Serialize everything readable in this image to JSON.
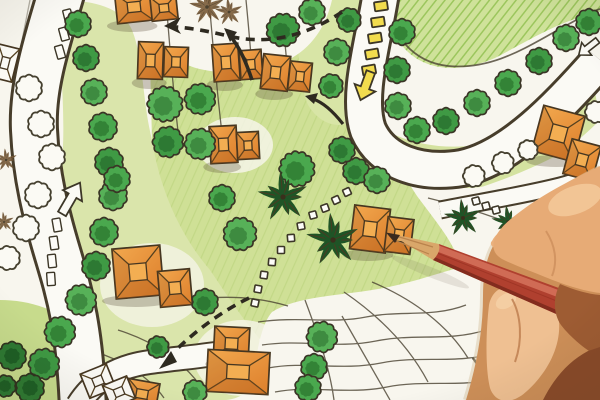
{
  "scene": {
    "title": "Landscape design site plan — colored pencil drawing",
    "description": "Photograph of a hand-drawn landscape architecture blueprint for a residential site: orange hip-roof villas, round green trees, palm symbols, curving white roads with yellow and white directional arrows, dashed pedestrian flow arrows, dotted stepping-stone walkways, and a designer's hand holding a red colored pencil pointing at a villa at center-right."
  },
  "palette": {
    "paper": "#f8f6ee",
    "lawn": "#cfe29a",
    "lawn_hatch": "#8fbf4e",
    "wash": "#dae5ab",
    "wash2": "#cfe096",
    "ink": "#3c3627",
    "tree_green": "#47a84b",
    "tree_green_dark": "#2e7d33",
    "palm_green": "#1f5426",
    "building_orange": "#eb9a40",
    "building_orange_dark": "#b25f1e",
    "road_white": "#fbfaf5",
    "marker_yellow": "#f2dc4e",
    "pencil_red": "#b0402f",
    "pencil_wood": "#d9a76a",
    "pencil_tip": "#3a2a1e",
    "skin_light": "#f3c99b",
    "skin_mid": "#e7ab76",
    "skin_base": "#cd8f58",
    "skin_shadow": "#9e5c33",
    "skin_deep": "#8a4b2a"
  },
  "plan": {
    "green_trees": [
      [
        78,
        24,
        12
      ],
      [
        86,
        58,
        12
      ],
      [
        94,
        92,
        12
      ],
      [
        103,
        127,
        13
      ],
      [
        109,
        162,
        13
      ],
      [
        113,
        196,
        13
      ],
      [
        104,
        232,
        13
      ],
      [
        96,
        266,
        13
      ],
      [
        81,
        300,
        14
      ],
      [
        60,
        332,
        14
      ],
      [
        44,
        364,
        14
      ],
      [
        165,
        104,
        16
      ],
      [
        200,
        99,
        14
      ],
      [
        168,
        142,
        14
      ],
      [
        200,
        144,
        14
      ],
      [
        117,
        179,
        12
      ],
      [
        283,
        30,
        15
      ],
      [
        312,
        12,
        12
      ],
      [
        297,
        169,
        16
      ],
      [
        356,
        171,
        12
      ],
      [
        240,
        234,
        15
      ],
      [
        222,
        198,
        12
      ],
      [
        205,
        302,
        12
      ],
      [
        322,
        337,
        14
      ],
      [
        314,
        367,
        12
      ],
      [
        158,
        347,
        10
      ],
      [
        195,
        392,
        11
      ],
      [
        308,
        388,
        12
      ],
      [
        349,
        20,
        11
      ],
      [
        337,
        52,
        12
      ],
      [
        331,
        86,
        11
      ],
      [
        342,
        150,
        12
      ],
      [
        377,
        180,
        12
      ],
      [
        402,
        32,
        12
      ],
      [
        397,
        70,
        12
      ],
      [
        398,
        106,
        12
      ],
      [
        417,
        130,
        12
      ],
      [
        446,
        121,
        12
      ],
      [
        477,
        103,
        12
      ],
      [
        508,
        83,
        12
      ],
      [
        539,
        61,
        12
      ],
      [
        566,
        38,
        12
      ],
      [
        589,
        22,
        12
      ]
    ],
    "dark_bushes": [
      [
        12,
        356,
        13
      ],
      [
        30,
        388,
        13
      ],
      [
        5,
        386,
        10
      ]
    ],
    "outline_trees": [
      [
        29,
        88,
        12
      ],
      [
        41,
        124,
        12
      ],
      [
        52,
        157,
        12
      ],
      [
        38,
        195,
        12
      ],
      [
        26,
        228,
        12
      ],
      [
        8,
        258,
        11
      ],
      [
        474,
        176,
        10
      ],
      [
        503,
        163,
        10
      ],
      [
        528,
        150,
        9
      ],
      [
        596,
        112,
        10
      ]
    ],
    "palms": [
      [
        283,
        197,
        1.0
      ],
      [
        333,
        240,
        1.05
      ],
      [
        463,
        218,
        0.75
      ],
      [
        508,
        222,
        0.65
      ],
      [
        588,
        192,
        0.5
      ]
    ],
    "sketch_palms": [
      [
        207,
        7,
        0.7
      ],
      [
        229,
        12,
        0.55
      ],
      [
        6,
        160,
        0.45
      ],
      [
        4,
        222,
        0.4
      ]
    ],
    "buildings": [
      {
        "blocks": [
          [
            116,
            -8,
            36,
            30,
            -6
          ],
          [
            151,
            -4,
            26,
            24,
            -6
          ]
        ]
      },
      {
        "blocks": [
          [
            138,
            42,
            25,
            37,
            2
          ],
          [
            164,
            47,
            24,
            30,
            2
          ]
        ]
      },
      {
        "blocks": [
          [
            213,
            44,
            26,
            37,
            -4
          ],
          [
            240,
            50,
            22,
            29,
            -4
          ]
        ]
      },
      {
        "blocks": [
          [
            262,
            55,
            27,
            35,
            6
          ],
          [
            289,
            62,
            22,
            29,
            6
          ]
        ]
      },
      {
        "blocks": [
          [
            210,
            126,
            27,
            37,
            -3
          ],
          [
            237,
            132,
            22,
            27,
            -3
          ]
        ]
      },
      {
        "blocks": [
          [
            537,
            110,
            43,
            47,
            15
          ],
          [
            567,
            142,
            30,
            36,
            15
          ]
        ]
      },
      {
        "blocks": [
          [
            352,
            207,
            36,
            44,
            7
          ],
          [
            386,
            218,
            26,
            35,
            7
          ]
        ]
      },
      {
        "blocks": [
          [
            114,
            247,
            48,
            50,
            -5
          ],
          [
            159,
            270,
            32,
            36,
            -5
          ]
        ]
      },
      {
        "blocks": [
          [
            214,
            327,
            35,
            33,
            3
          ],
          [
            207,
            351,
            62,
            42,
            3
          ]
        ]
      },
      {
        "blocks": [
          [
            126,
            381,
            32,
            26,
            10
          ]
        ]
      }
    ],
    "outline_buildings": [
      {
        "blocks": [
          [
            -6,
            46,
            22,
            34,
            14
          ]
        ]
      },
      {
        "blocks": [
          [
            84,
            368,
            28,
            26,
            -22
          ],
          [
            106,
            380,
            26,
            24,
            -22
          ]
        ]
      }
    ],
    "walk_dots": [
      [
        347,
        192,
        -25
      ],
      [
        336,
        200,
        -25
      ],
      [
        325,
        208,
        -20
      ],
      [
        313,
        215,
        -15
      ],
      [
        301,
        226,
        -10
      ],
      [
        291,
        238,
        -5
      ],
      [
        281,
        250,
        0
      ],
      [
        272,
        262,
        5
      ],
      [
        264,
        275,
        8
      ],
      [
        258,
        289,
        10
      ],
      [
        255,
        303,
        12
      ],
      [
        476,
        201,
        -15
      ],
      [
        486,
        206,
        -15
      ],
      [
        496,
        210,
        -15
      ]
    ],
    "yellow_dashes": [
      [
        381,
        6,
        -8
      ],
      [
        378,
        22,
        -8
      ],
      [
        375,
        38,
        -9
      ],
      [
        372,
        54,
        -10
      ],
      [
        369,
        70,
        -10
      ]
    ],
    "road_dashes": [
      [
        68,
        16,
        -14
      ],
      [
        64,
        34,
        -15
      ],
      [
        60,
        52,
        -16
      ],
      [
        57,
        225,
        -10
      ],
      [
        54,
        243,
        -8
      ],
      [
        52,
        261,
        -6
      ],
      [
        51,
        279,
        -4
      ]
    ]
  }
}
